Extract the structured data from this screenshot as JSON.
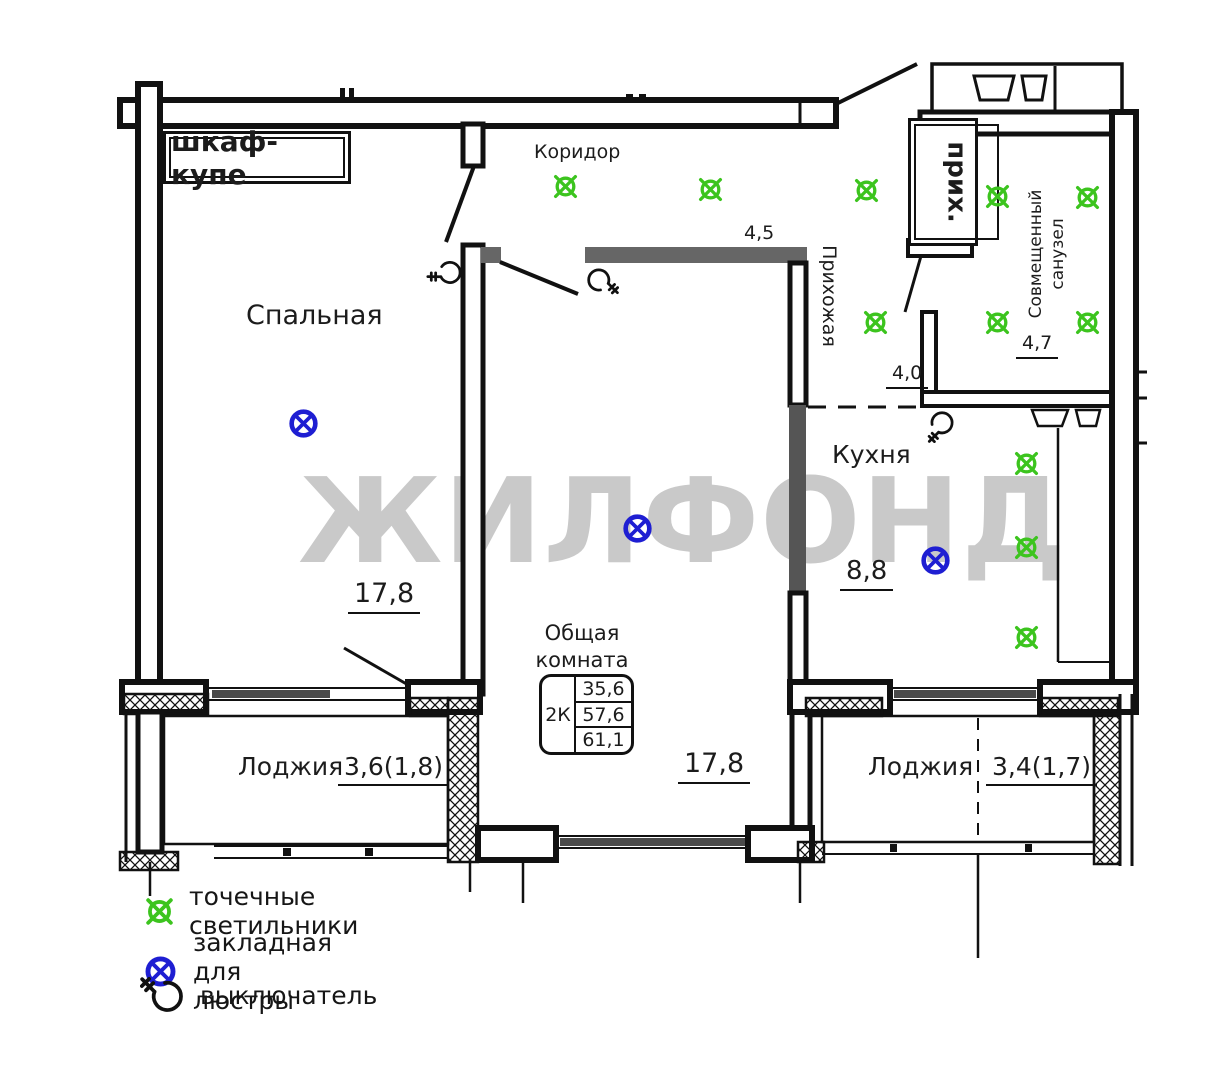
{
  "labels": {
    "wardrobe": "шкаф-купе",
    "bedroom": "Спальная",
    "bedroom_area": "17,8",
    "corridor": "Коридор",
    "corridor_dim": "4,5",
    "hallway": "Прихожая",
    "hallway_short": "прих.",
    "hallway_dim": "4,0",
    "bathroom_line1": "Совмещенный",
    "bathroom_line2": "санузел",
    "bathroom_area": "4,7",
    "kitchen": "Кухня",
    "kitchen_area": "8,8",
    "living_line1": "Общая",
    "living_line2": "комната",
    "living_area": "17,8",
    "loggia_left": "Лоджия",
    "loggia_left_area": "3,6(1,8)",
    "loggia_right": "Лоджия",
    "loggia_right_area": "3,4(1,7)"
  },
  "info_table": {
    "type": "2К",
    "rows": [
      "35,6",
      "57,6",
      "61,1"
    ]
  },
  "watermark": "ЖИЛФОНД",
  "legend": [
    {
      "symbol": "spot-light",
      "label": "точечные светильники"
    },
    {
      "symbol": "chandelier-mount",
      "label": "закладная для люстры"
    },
    {
      "symbol": "switch",
      "label": "выключатель"
    }
  ],
  "colors": {
    "spot_light": "#3cc41e",
    "chandelier_mount": "#1e1ed2",
    "watermark": "#c9c9c9",
    "line": "#111111",
    "wall_gray": "#5f5f5f"
  },
  "symbols": {
    "spot_lights": [
      {
        "x": 565,
        "y": 186
      },
      {
        "x": 710,
        "y": 189
      },
      {
        "x": 866,
        "y": 190
      },
      {
        "x": 875,
        "y": 322
      },
      {
        "x": 997,
        "y": 196
      },
      {
        "x": 1087,
        "y": 197
      },
      {
        "x": 997,
        "y": 322
      },
      {
        "x": 1087,
        "y": 322
      },
      {
        "x": 1026,
        "y": 463
      },
      {
        "x": 1026,
        "y": 547
      },
      {
        "x": 1026,
        "y": 637
      }
    ],
    "chandelier_mounts": [
      {
        "x": 303,
        "y": 423
      },
      {
        "x": 637,
        "y": 528
      },
      {
        "x": 935,
        "y": 560
      }
    ],
    "switches": [
      {
        "x": 447,
        "y": 274,
        "rot": -135
      },
      {
        "x": 602,
        "y": 281,
        "rot": 90
      },
      {
        "x": 941,
        "y": 426,
        "rot": 180
      }
    ]
  }
}
